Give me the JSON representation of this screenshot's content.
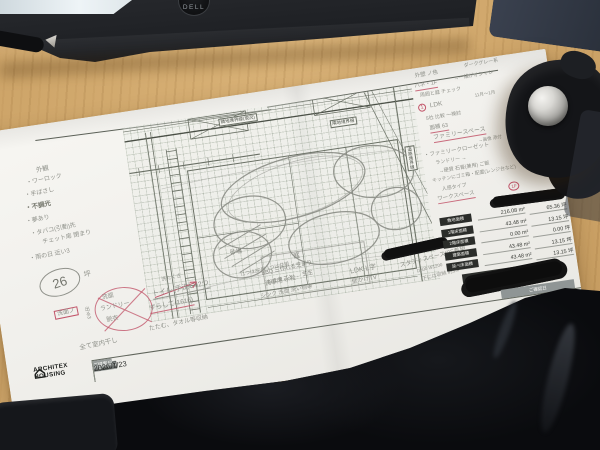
{
  "scene": {
    "laptop_brand": "DELL"
  },
  "paper": {
    "company_name": "ARCHITEX HOUSING",
    "title_block": {
      "memo_header": "注記・メモ",
      "name_header": "図面名称",
      "name_value": "配置図",
      "scale_header": "縮尺",
      "scale_value": "1/100",
      "date_header": "ご提案日",
      "date_value": "2026/1/23"
    },
    "right_panel": {
      "rows": [
        {
          "label": "敷地面積",
          "sqm": "216.08 m²",
          "tsubo": "65.36 坪"
        },
        {
          "label": "1階床面積",
          "sqm": "43.48 m²",
          "tsubo": "13.15 坪"
        },
        {
          "label": "2階床面積",
          "sqm": "0.00 m²",
          "tsubo": "0.00 坪"
        },
        {
          "label": "建築面積",
          "sqm": "43.48 m²",
          "tsubo": "13.15 坪"
        },
        {
          "label": "延べ床面積",
          "sqm": "43.48 m²",
          "tsubo": "13.15 坪"
        }
      ],
      "building_name_header": "建物名称",
      "confirm_date_header": "ご確認日"
    },
    "plan": {
      "label_boundary_top": "隣地境界線(現況)",
      "label_boundary_mid": "隣地境界線",
      "label_boundary_right": "道路境界線",
      "sandbox_label": "砂場",
      "garden_label": "庭",
      "garden_note_1": "BBQ 三作れる芝あり",
      "garden_note_2": "おままごと ← 芝生"
    },
    "notes": {
      "left": {
        "title": "外観",
        "i1": "・ワーロック",
        "i2": "・手ばさし",
        "i3": "・不調光",
        "i4": "・夢あり",
        "i5": "・タバコ(引動)先",
        "i6": "　チェット扉 閉まり",
        "i7": "・雨の日 近い3",
        "area_value": "26",
        "area_unit": "坪"
      },
      "laundry": {
        "box": "洗面ノ",
        "c1": "洗面",
        "c2": "ランドリー",
        "c3": "脱衣",
        "side": "出る3",
        "arrow_note": "洗たくき",
        "line1": "全て室内干し",
        "line2": "たたむ、タオル等収納"
      },
      "toilet": {
        "t1": "トイレ(手洗い)2つ",
        "t2": "｛1つは2F用 1つは共用",
        "t3": "ずらして(1616)",
        "s1": "洗車用 水栓",
        "s2": "シンク 洗面 洗い物等"
      },
      "ldk_block": {
        "l1": "LDK L字",
        "l2": "壁かけTV",
        "l3": "スタディスペース(2F希望",
        "l4": "D600 W1200",
        "l5": "下には収納 約1.0"
      },
      "right": {
        "r1": "外壁 ノ色",
        "r1b": "ダークグレー系",
        "r2": "パネ・1F",
        "r2b": "→一緒がオシャレ",
        "r3": "周囲と庭 チェック",
        "r4_num": "1",
        "r4": "LDK",
        "r4b": "11月〜1月",
        "r5": "5社 比較 〜検討",
        "r6": "面積 63",
        "r7": "ファミリースペース",
        "r7b": "→画像 添付",
        "r8": "・ファミリークローゼット",
        "r9": "ランドリー →",
        "r10": "→硬質 石膏(兼用) ご飯",
        "r11": "キッチンにゴミ箱・配置(レンジ台など)",
        "r12": "人感タイプ",
        "r13": "ワークスペース",
        "r13_badge": "1F"
      }
    }
  }
}
